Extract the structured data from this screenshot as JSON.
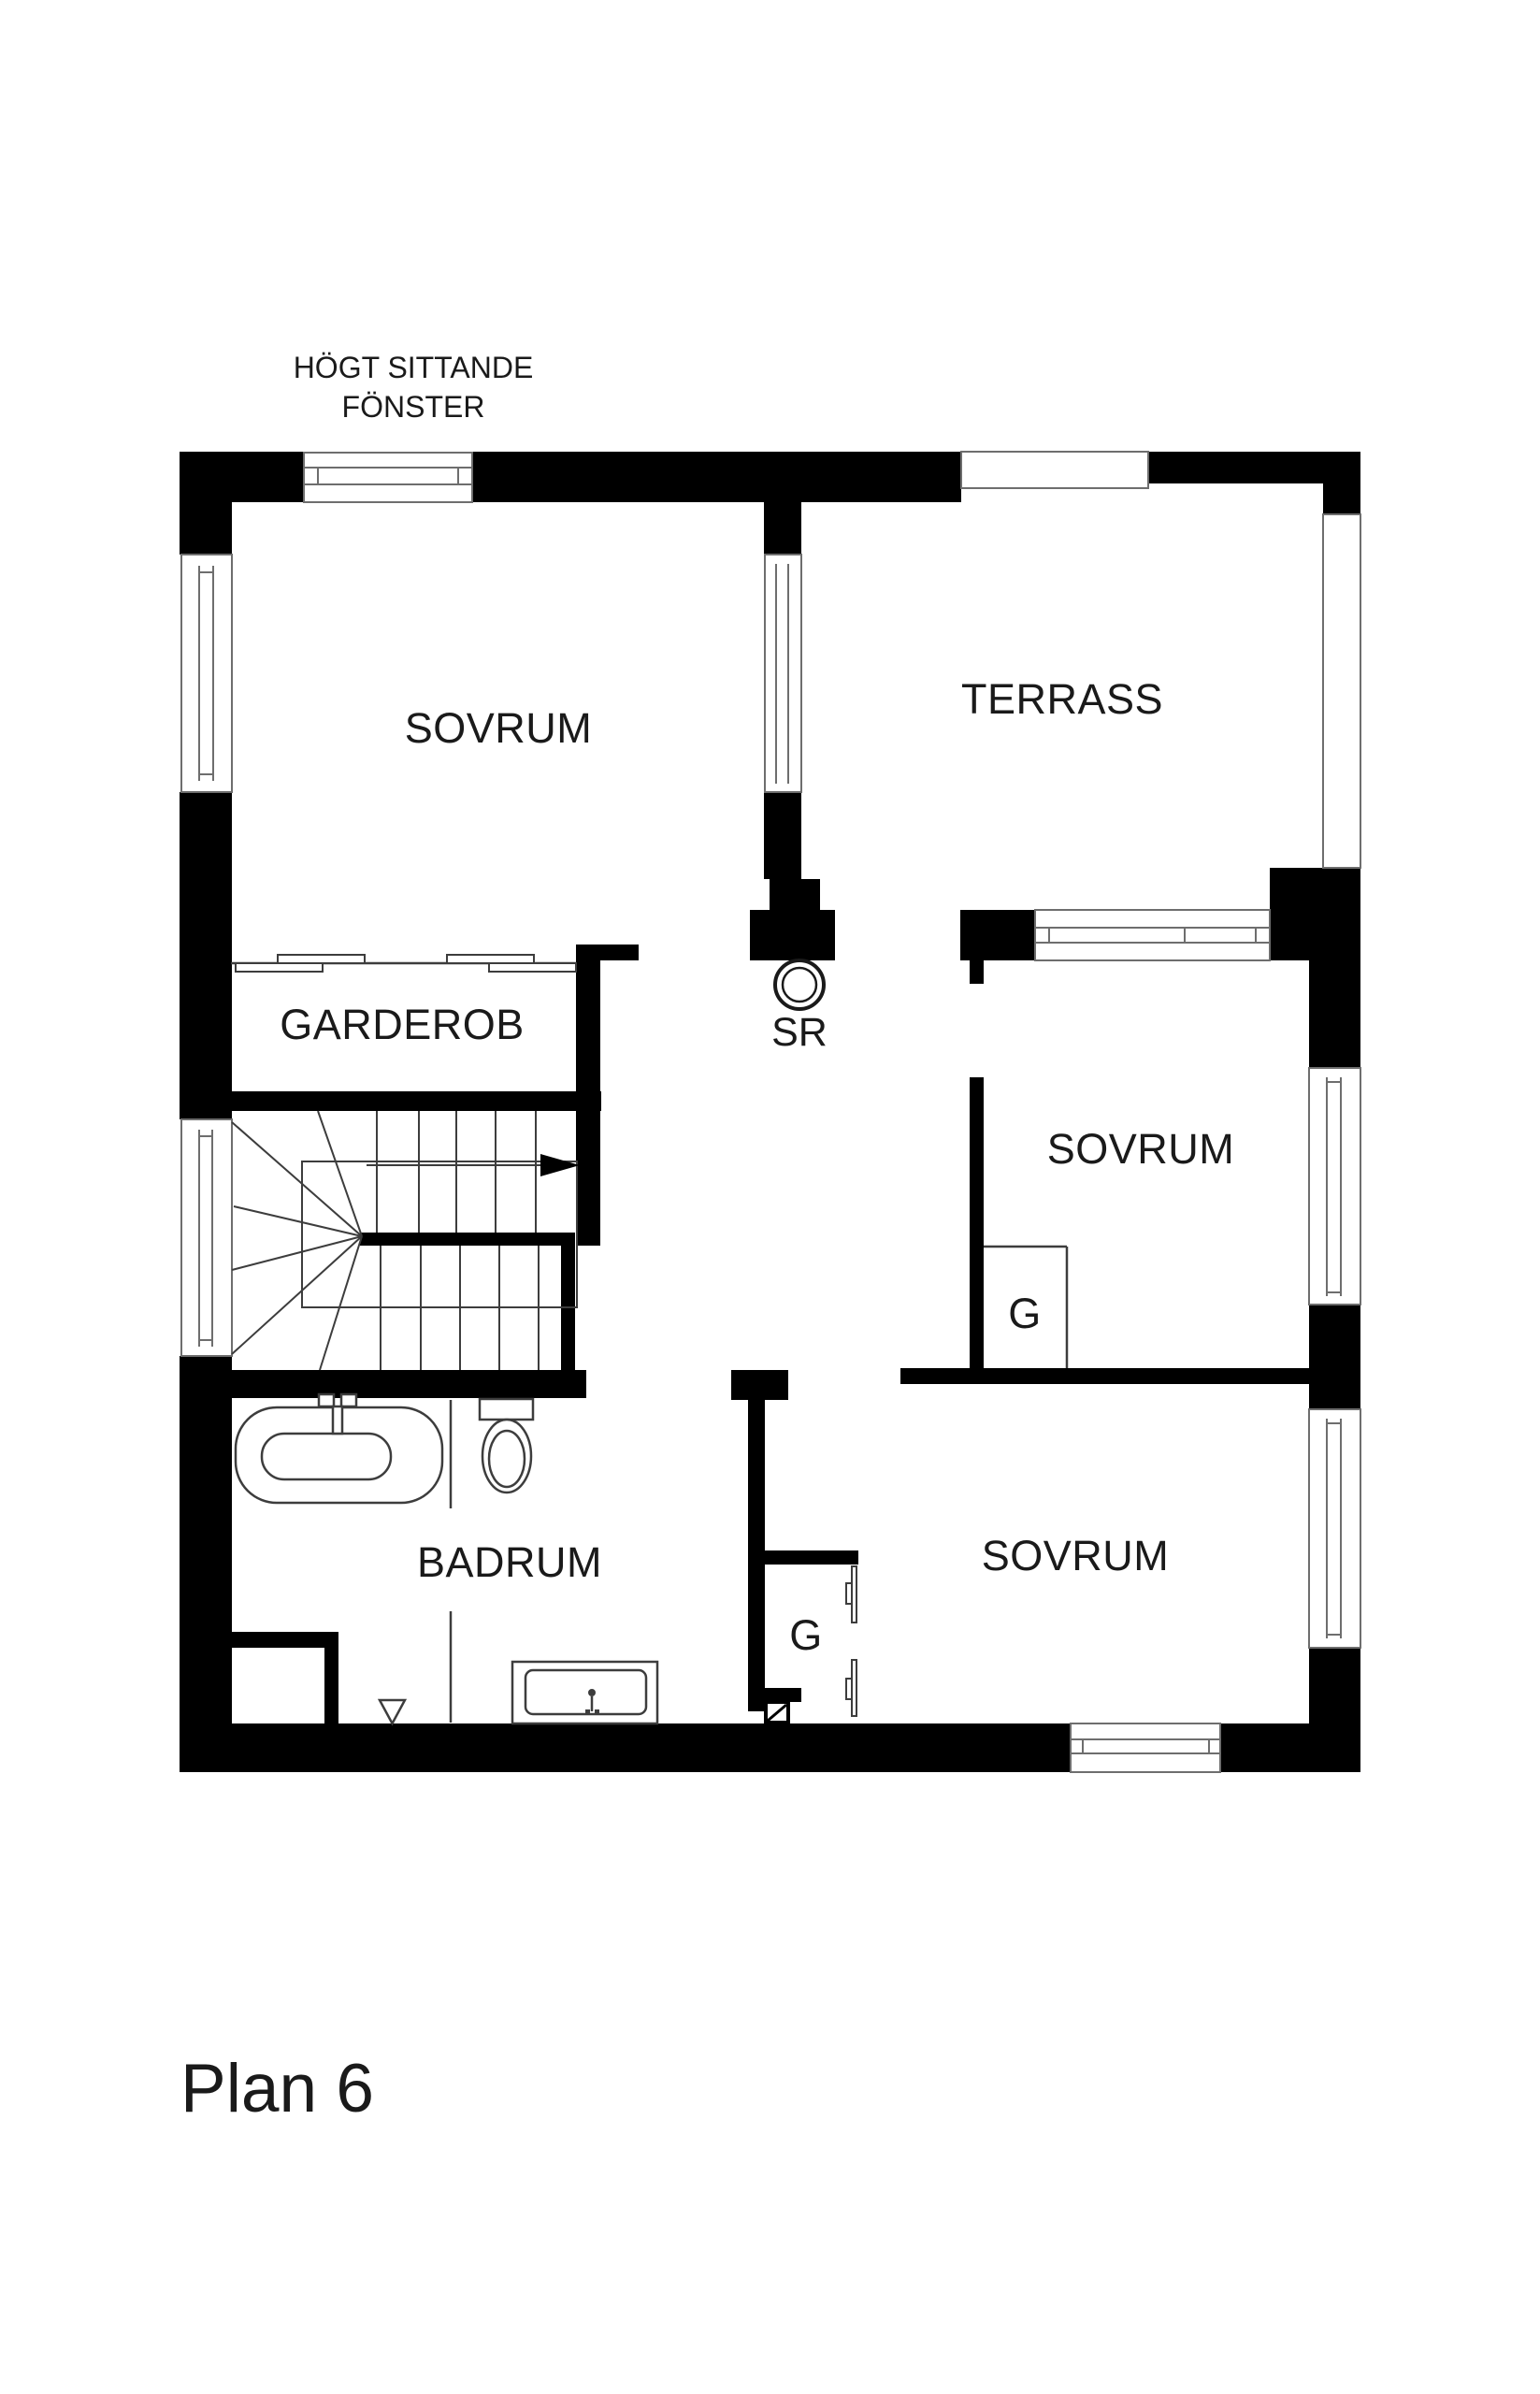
{
  "annotation": {
    "line1": "HÖGT SITTANDE",
    "line2": "FÖNSTER"
  },
  "title": "Plan 6",
  "rooms": {
    "bedroom_top": "SOVRUM",
    "terrace": "TERRASS",
    "wardrobe": "GARDEROB",
    "bedroom_mid": "SOVRUM",
    "bathroom": "BADRUM",
    "bedroom_bottom": "SOVRUM"
  },
  "markers": {
    "smoke_shaft": "SR",
    "closet_mid": "G",
    "closet_bottom": "G"
  },
  "colors": {
    "wall": "#000000",
    "line": "#3d3d3d",
    "window_border": "#6e6e6e",
    "text": "#1a1a1a",
    "background": "#ffffff"
  }
}
